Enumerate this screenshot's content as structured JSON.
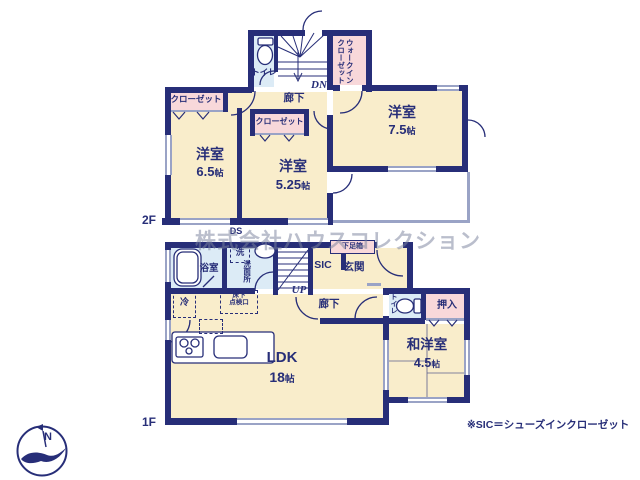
{
  "colors": {
    "wall": "#272e78",
    "room_cream": "#f9edcb",
    "closet_pink": "#f8d8da",
    "wet_blue": "#dcebf6",
    "text_navy": "#272e78",
    "window_line": "#9aa3c6"
  },
  "floor2": {
    "floor_label": "2F",
    "toilet": "トイレ",
    "dn": "DN",
    "wic_line1": "ウォークイン",
    "wic_line2": "クローゼット",
    "closet_left": "クローゼット",
    "closet_small": "クローゼット",
    "hallway": "廊下",
    "room65_name": "洋室",
    "room65_size": "6.5",
    "room525_name": "洋室",
    "room525_size": "5.25",
    "room75_name": "洋室",
    "room75_size": "7.5",
    "ds": "DS"
  },
  "floor1": {
    "floor_label": "1F",
    "bath": "浴室",
    "washer": "洗",
    "washroom": "洗面所",
    "up": "UP",
    "sic": "SIC",
    "entrance": "玄関",
    "shoe_cabinet": "下足箱",
    "hallway": "廊下",
    "toilet": "トイレ",
    "oshiire": "押入",
    "fridge": "冷",
    "inspection_line1": "床下",
    "inspection_line2": "点検口",
    "ldk_name": "LDK",
    "ldk_size": "18",
    "washitsu_name": "和洋室",
    "washitsu_size": "4.5"
  },
  "units": {
    "jo": "帖"
  },
  "watermark": "株式会社ハウスコレクション",
  "footnote": "※SIC＝シューズインクローゼット",
  "compass": {
    "north": "N"
  }
}
